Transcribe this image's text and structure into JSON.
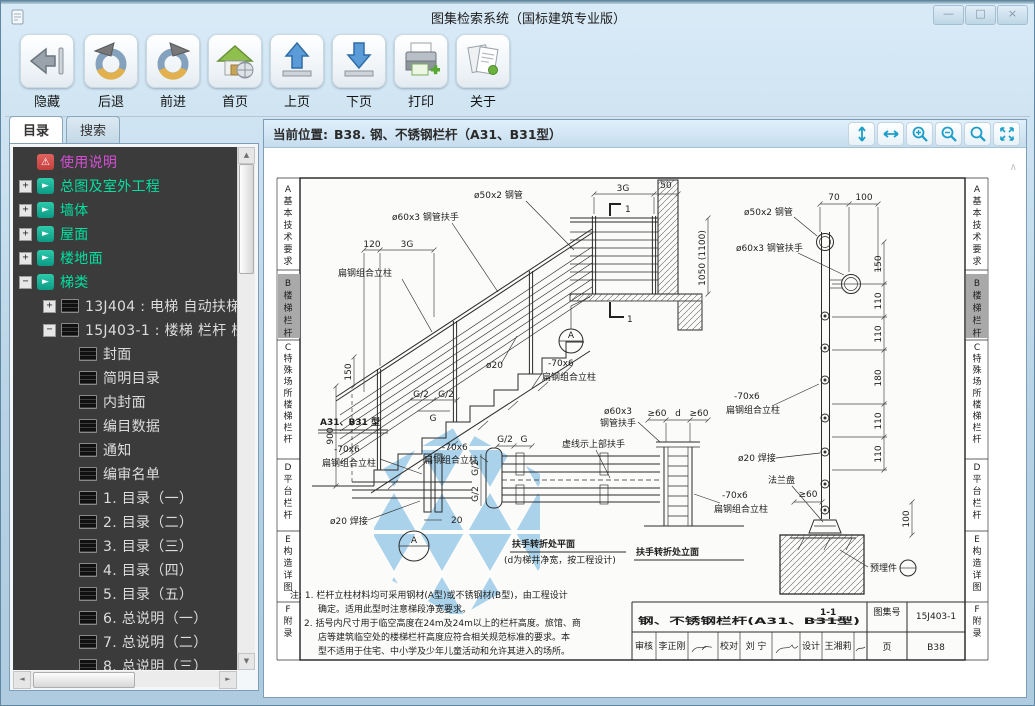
{
  "window": {
    "title": "图集检索系统（国标建筑专业版）",
    "controls": [
      {
        "name": "minimize",
        "glyph": "—"
      },
      {
        "name": "maximize",
        "glyph": "□"
      },
      {
        "name": "close",
        "glyph": "×"
      }
    ]
  },
  "toolbar": {
    "buttons": [
      {
        "label": "隐藏",
        "icon": "hide-arrow-icon"
      },
      {
        "label": "后退",
        "icon": "back-circle-icon"
      },
      {
        "label": "前进",
        "icon": "forward-circle-icon"
      },
      {
        "label": "首页",
        "icon": "home-icon"
      },
      {
        "label": "上页",
        "icon": "page-up-icon"
      },
      {
        "label": "下页",
        "icon": "page-down-icon"
      },
      {
        "label": "打印",
        "icon": "print-icon"
      },
      {
        "label": "关于",
        "icon": "about-icon"
      }
    ]
  },
  "sidebar": {
    "tabs": [
      {
        "label": "目录",
        "active": true
      },
      {
        "label": "搜索",
        "active": false
      }
    ],
    "tree": {
      "items": [
        {
          "label": "使用说明",
          "type": "notice"
        },
        {
          "label": "总图及室外工程",
          "type": "category",
          "state": "collapsed"
        },
        {
          "label": "墙体",
          "type": "category",
          "state": "collapsed"
        },
        {
          "label": "屋面",
          "type": "category",
          "state": "collapsed"
        },
        {
          "label": "楼地面",
          "type": "category",
          "state": "collapsed"
        },
        {
          "label": "梯类",
          "type": "category",
          "state": "expanded"
        },
        {
          "label": "13J404 : 电梯 自动扶梯 自动",
          "type": "atlas",
          "state": "collapsed"
        },
        {
          "label": "15J403-1 : 楼梯 栏杆 栏板",
          "type": "atlas",
          "state": "expanded"
        },
        {
          "label": "封面",
          "type": "page"
        },
        {
          "label": "简明目录",
          "type": "page"
        },
        {
          "label": "内封面",
          "type": "page"
        },
        {
          "label": "编目数据",
          "type": "page"
        },
        {
          "label": "通知",
          "type": "page"
        },
        {
          "label": "编审名单",
          "type": "page"
        },
        {
          "label": "1. 目录（一）",
          "type": "page"
        },
        {
          "label": "2. 目录（二）",
          "type": "page"
        },
        {
          "label": "3. 目录（三）",
          "type": "page"
        },
        {
          "label": "4. 目录（四）",
          "type": "page"
        },
        {
          "label": "5. 目录（五）",
          "type": "page"
        },
        {
          "label": "6. 总说明（一）",
          "type": "page"
        },
        {
          "label": "7. 总说明（二）",
          "type": "page"
        },
        {
          "label": "8. 总说明（三）",
          "type": "page"
        }
      ]
    }
  },
  "viewer": {
    "position_label": "当前位置:",
    "position_value": "B38. 钢、不锈钢栏杆（A31、B31型）",
    "zoom_tools": [
      {
        "name": "fit-height"
      },
      {
        "name": "fit-width"
      },
      {
        "name": "zoom-in"
      },
      {
        "name": "zoom-out"
      },
      {
        "name": "zoom"
      },
      {
        "name": "fit-page"
      }
    ],
    "accent_color": "#1b9ec9"
  },
  "ui": {
    "plus": "+",
    "minus": "−",
    "arrow": "►",
    "warn": "⚠",
    "up": "▲",
    "down": "▼",
    "left": "◄",
    "right": "►",
    "chev": "∧"
  },
  "drawing": {
    "page_tabs": [
      {
        "text": "A基本技术要求"
      },
      {
        "text": "B楼梯栏杆"
      },
      {
        "text": "C特殊场所楼梯栏杆"
      },
      {
        "text": "D平台栏杆"
      },
      {
        "text": "E构造详图"
      },
      {
        "text": "F附录"
      }
    ],
    "labels": {
      "pipe50": "ø50x2 钢管",
      "handrail60": "ø60x3 钢管扶手",
      "handrail60a": "ø60x3",
      "handrail60b": "钢管扶手",
      "post_size": "-70x6",
      "post_name": "扁钢组合立柱",
      "weld": "ø20 焊接",
      "pin20": "ø20",
      "flange": "法兰盘",
      "embed": "预埋件",
      "dashed_note": "虚线示上部扶手",
      "type_title": "A31、B31 型",
      "plan_title": "扶手转折处平面",
      "plan_sub": "(d为梯井净宽，按工程设计)",
      "elev_title": "扶手转折处立面",
      "section_title": "1-1",
      "mark1": "1",
      "detail_a": "A"
    },
    "dims": {
      "d120": "120",
      "g3": "3G",
      "d150": "150",
      "d900": "900",
      "d50": "50",
      "h1050": "1050 (1100)",
      "d70": "70",
      "d100": "100",
      "d110": "110",
      "d180": "180",
      "ge60": "≥60",
      "ghalf": "G/2",
      "g": "G",
      "d": "d",
      "d20": "20"
    },
    "notes": [
      "注: 1. 栏杆立柱材料均可采用钢材(A型)或不锈钢材(B型)，由工程设计",
      "确定。适用此型时注意梯段净宽要求。",
      "2. 括号内尺寸用于临空高度在24m及24m以上的栏杆高度。旅馆、商",
      "店等建筑临空处的楼梯栏杆高度应符合相关规范标准的要求。本",
      "型不适用于住宅、中小学及少年儿童活动和允许其进入的场所。"
    ],
    "title_block": {
      "title": "钢、不锈钢栏杆(A31、B31型)",
      "atlas_no_label": "图集号",
      "atlas_no": "15J403-1",
      "page_label": "页",
      "page": "B38",
      "review_label": "审核",
      "review": "李正刚",
      "check_label": "校对",
      "check": "刘 宁",
      "design_label": "设计",
      "design": "王湘莉"
    }
  }
}
